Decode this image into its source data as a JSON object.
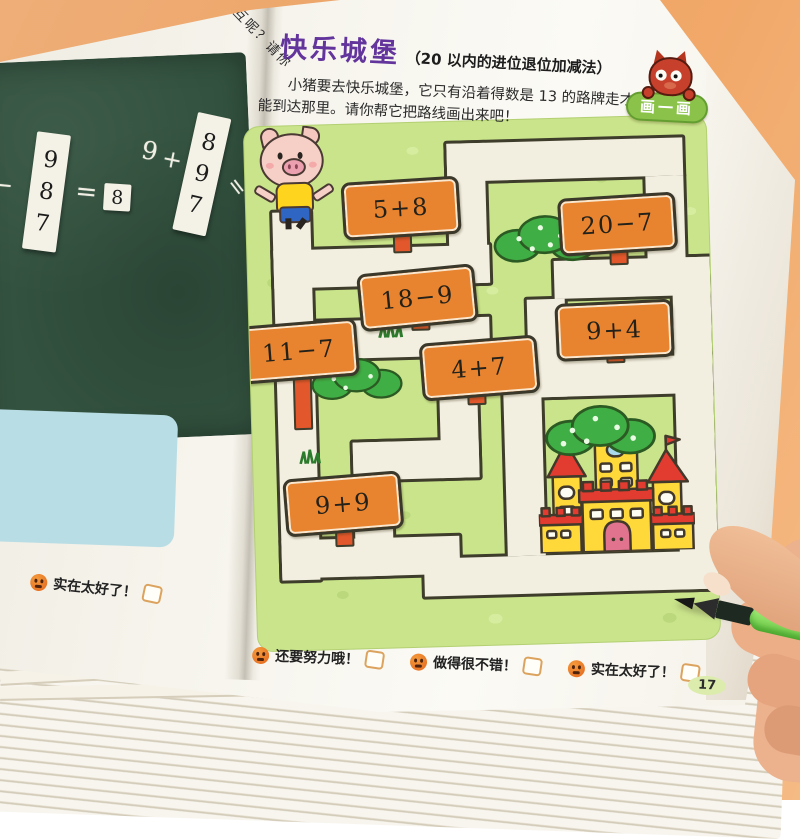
{
  "book": {
    "prev_page_fragment": "互呢？请你",
    "left_page": {
      "chalkboard": {
        "left_lead": "6",
        "left_operator": "−",
        "left_strip": [
          "9",
          "8",
          "7"
        ],
        "equals_sign": "=",
        "answer": "8",
        "right_addend": "9",
        "plus_sign": "+",
        "right_strip": [
          "8",
          "9",
          "7"
        ],
        "right_equals": "="
      },
      "feedback_label": "实在太好了！"
    },
    "right_page": {
      "title": "快乐城堡",
      "subtitle": "（20 以内的进位退位加减法）",
      "instructions": [
        "小猪要去快乐城堡，它只有沿着得数是 13 的路牌走才",
        "能到达那里。请你帮它把路线画出来吧！"
      ],
      "badge_label": "画一画",
      "maze_signs": [
        "5+8",
        "20−7",
        "18−9",
        "9+4",
        "11−7",
        "4+7",
        "9+9"
      ],
      "feedback_items": [
        "还要努力哦！",
        "做得很不错！",
        "实在太好了！"
      ],
      "page_number": "17"
    }
  },
  "colors": {
    "background_orange": "#eca466",
    "title_purple": "#62349c",
    "sign_orange": "#e8842f",
    "post_red": "#e2572b",
    "maze_green": "#c9e48b",
    "badge_green": "#8bc34a",
    "chalkboard_green": "#33523f"
  }
}
